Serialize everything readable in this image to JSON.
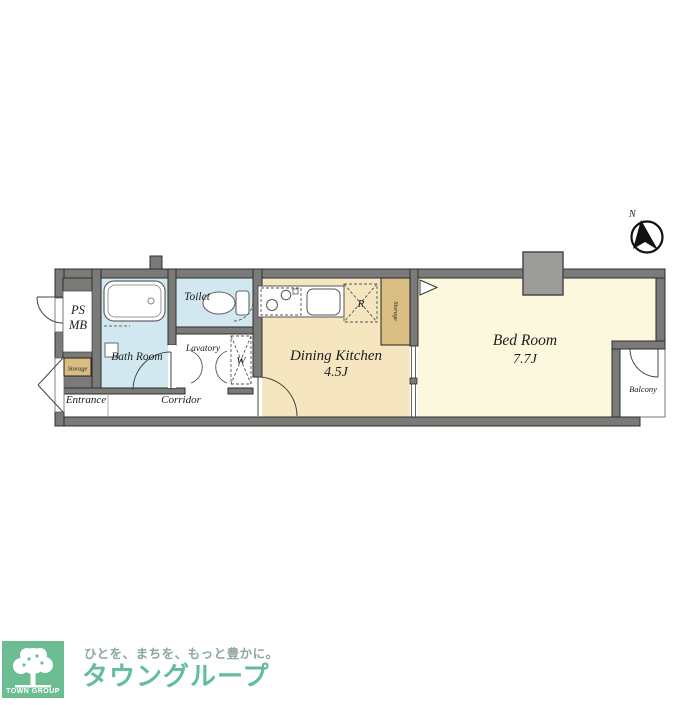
{
  "floorplan": {
    "compass_label": "N",
    "rooms": {
      "ps": "PS",
      "mb": "MB",
      "storage_small": "Storage",
      "bath": "Bath Room",
      "toilet": "Toilet",
      "lavatory": "Lavatory",
      "washer": "W",
      "entrance": "Entrance",
      "corridor": "Corridor",
      "dk_name": "Dining Kitchen",
      "dk_size": "4.5J",
      "refrigerator": "R",
      "storage_tall": "Storage",
      "bedroom_name": "Bed Room",
      "bedroom_size": "7.7J",
      "balcony": "Balcony"
    },
    "colors": {
      "wall": "#7a7a78",
      "bath_floor": "#d2e8f0",
      "dk_floor": "#f6e6c0",
      "bedroom_floor": "#fbf8de",
      "storage_fill": "#d9bd83",
      "pillar": "#9c9c9a"
    }
  },
  "footer": {
    "brand_square": "TOWN GROUP",
    "tagline": "ひとを、まちを、もっと豊かに。",
    "brand_name": "タウングループ",
    "colors": {
      "square_bg": "#6cbe92",
      "brand_text": "#63bca2",
      "tagline_text": "#8fa59f"
    }
  }
}
